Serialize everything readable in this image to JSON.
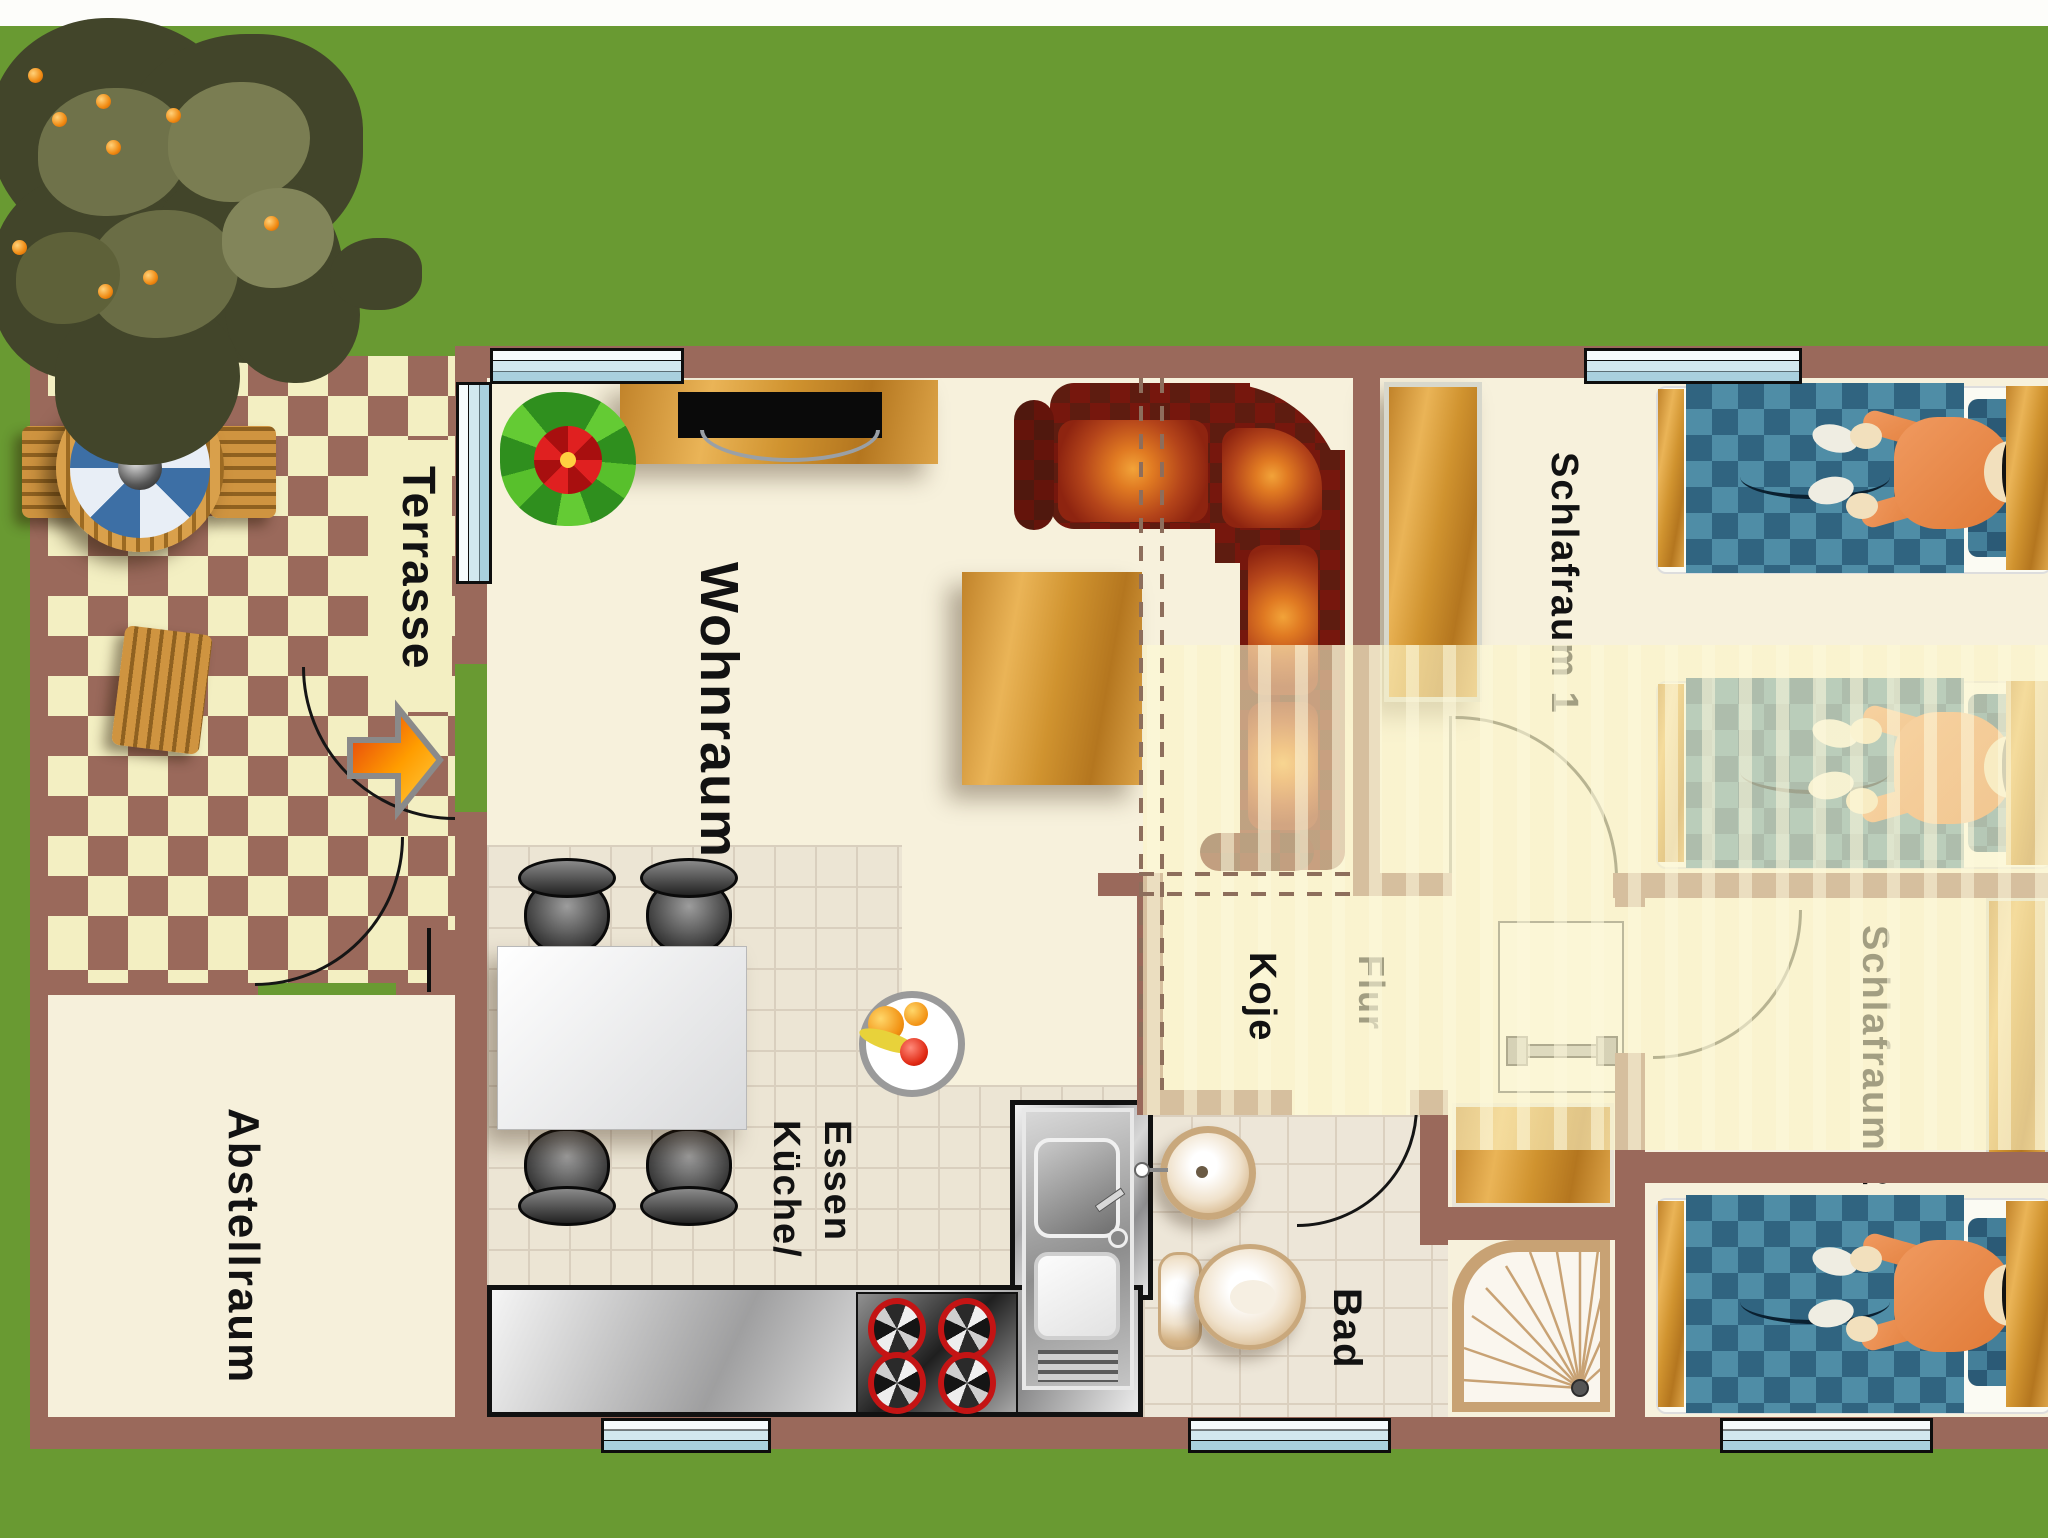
{
  "scene": {
    "type": "floor-plan-top-view"
  },
  "rooms": {
    "terrasse": {
      "label": "Terrasse"
    },
    "wohnraum": {
      "label": "Wohnraum"
    },
    "abstellraum": {
      "label": "Abstellraum"
    },
    "kueche": {
      "label_line1": "Küche/",
      "label_line2": "Essen"
    },
    "koje": {
      "label": "Koje"
    },
    "flur": {
      "label": "Flur"
    },
    "bad": {
      "label": "Bad"
    },
    "schlafraum1": {
      "label": "Schlafraum 1"
    },
    "schlafraum2": {
      "label": "Schlafraum 2"
    }
  },
  "palette": {
    "grass": "#699A32",
    "wall": "#9A695B",
    "checker_brown": "#9A695B",
    "checker_cream": "#F3EFC2",
    "floor_cream": "#F7F1DC",
    "corridor_stripe": "#FBF4C7",
    "kitchen_tile": "#ECE5D4",
    "wood": "#D0932F",
    "sofa_red": "#76170D",
    "cushion_orange": "#E07A22",
    "blanket_blue_dark": "#306480",
    "blanket_blue_light": "#4F8DA6",
    "person_shirt": "#E8894E",
    "window_glass": "#D2E8EF",
    "arrow_orange": "#FF9D00"
  }
}
